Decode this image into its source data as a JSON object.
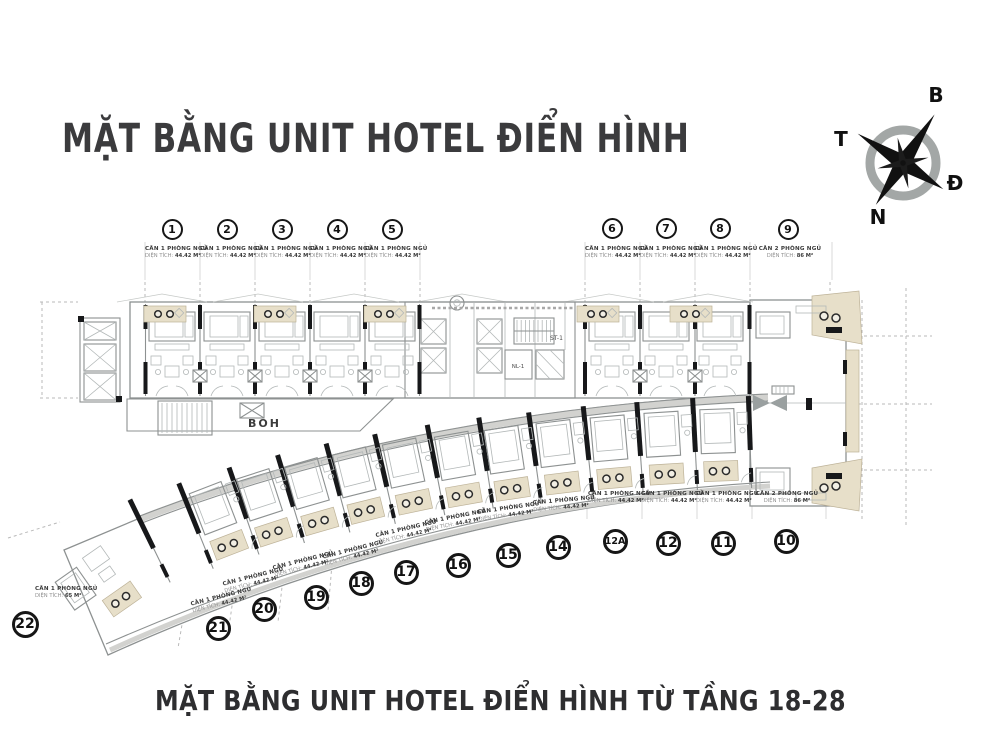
{
  "header": {
    "title": "MẶT BẰNG UNIT HOTEL ĐIỂN HÌNH"
  },
  "footer": {
    "title": "MẶT BẰNG UNIT HOTEL ĐIỂN HÌNH TỪ TẦNG 18-28"
  },
  "compass": {
    "north_label": "B",
    "east_label": "Đ",
    "south_label": "N",
    "west_label": "T"
  },
  "plan": {
    "back_of_house": "BOH",
    "stair": "ST-1",
    "lift_lobby": "NL-1",
    "colors": {
      "accent_beige": "#e7dfc9",
      "wall_dark": "#17181a",
      "line_gray": "#8d9191",
      "title_color": "#3b3b3d"
    }
  },
  "units": [
    {
      "id": "1",
      "type": "CĂN 1 PHÒNG NGỦ",
      "area_label": "DIỆN TÍCH:",
      "area_value": "44.42 M²"
    },
    {
      "id": "2",
      "type": "CĂN 1 PHÒNG NGỦ",
      "area_label": "DIỆN TÍCH:",
      "area_value": "44.42 M²"
    },
    {
      "id": "3",
      "type": "CĂN 1 PHÒNG NGỦ",
      "area_label": "DIỆN TÍCH:",
      "area_value": "44.42 M²"
    },
    {
      "id": "4",
      "type": "CĂN 1 PHÒNG NGỦ",
      "area_label": "DIỆN TÍCH:",
      "area_value": "44.42 M²"
    },
    {
      "id": "5",
      "type": "CĂN 1 PHÒNG NGỦ",
      "area_label": "DIỆN TÍCH:",
      "area_value": "44.42 M²"
    },
    {
      "id": "6",
      "type": "CĂN 1 PHÒNG NGỦ",
      "area_label": "DIỆN TÍCH:",
      "area_value": "44.42 M²"
    },
    {
      "id": "7",
      "type": "CĂN 1 PHÒNG NGỦ",
      "area_label": "DIỆN TÍCH:",
      "area_value": "44.42 M²"
    },
    {
      "id": "8",
      "type": "CĂN 1 PHÒNG NGỦ",
      "area_label": "DIỆN TÍCH:",
      "area_value": "44.42 M²"
    },
    {
      "id": "9",
      "type": "CĂN 2 PHÒNG NGỦ",
      "area_label": "DIỆN TÍCH:",
      "area_value": "86 M²"
    },
    {
      "id": "10",
      "type": "CĂN 2 PHÒNG NGỦ",
      "area_label": "DIỆN TÍCH:",
      "area_value": "86 M²"
    },
    {
      "id": "11",
      "type": "CĂN 1 PHÒNG NGỦ",
      "area_label": "DIỆN TÍCH:",
      "area_value": "44.42 M²"
    },
    {
      "id": "12",
      "type": "CĂN 1 PHÒNG NGỦ",
      "area_label": "DIỆN TÍCH:",
      "area_value": "44.42 M²"
    },
    {
      "id": "12A",
      "type": "CĂN 1 PHÒNG NGỦ",
      "area_label": "DIỆN TÍCH:",
      "area_value": "44.42 M²"
    },
    {
      "id": "14",
      "type": "CĂN 1 PHÒNG NGỦ",
      "area_label": "DIỆN TÍCH:",
      "area_value": "44.42 M²"
    },
    {
      "id": "15",
      "type": "CĂN 1 PHÒNG NGỦ",
      "area_label": "DIỆN TÍCH:",
      "area_value": "44.42 M²"
    },
    {
      "id": "16",
      "type": "CĂN 1 PHÒNG NGỦ",
      "area_label": "DIỆN TÍCH:",
      "area_value": "44.42 M²"
    },
    {
      "id": "17",
      "type": "CĂN 1 PHÒNG NGỦ",
      "area_label": "DIỆN TÍCH:",
      "area_value": "44.42 M²"
    },
    {
      "id": "18",
      "type": "CĂN 1 PHÒNG NGỦ",
      "area_label": "DIỆN TÍCH:",
      "area_value": "44.42 M²"
    },
    {
      "id": "19",
      "type": "CĂN 1 PHÒNG NGỦ",
      "area_label": "DIỆN TÍCH:",
      "area_value": "44.42 M²"
    },
    {
      "id": "20",
      "type": "CĂN 1 PHÒNG NGỦ",
      "area_label": "DIỆN TÍCH:",
      "area_value": "44.42 M²"
    },
    {
      "id": "21",
      "type": "CĂN 1 PHÒNG NGỦ",
      "area_label": "DIỆN TÍCH:",
      "area_value": "44.42 M²"
    },
    {
      "id": "22",
      "type": "CĂN 1 PHÒNG NGỦ",
      "area_label": "DIỆN TÍCH:",
      "area_value": "65 M²"
    }
  ]
}
